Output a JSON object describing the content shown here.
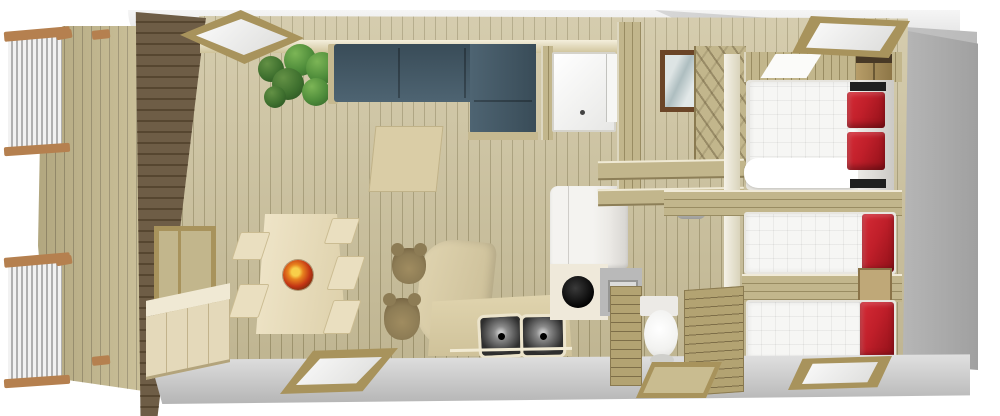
{
  "scene": {
    "kind": "3d-floorplan-render",
    "description": "Bird's-eye cutaway 3D rendering of a mobile-home / chalet floor plan with terrace",
    "background": "#ffffff",
    "width": 1000,
    "height": 416
  },
  "palette": {
    "floor_wood": "#cbc09a",
    "floor_line": "#a59a72",
    "deck_wood": "#c6ba8e",
    "deck_line": "#9e9370",
    "dark_wall": "#6e5d46",
    "dark_wall_line": "#564630",
    "wall_wood": "#c2b68c",
    "wall_wood_line": "#998c62",
    "roof_light": "#f5f5f5",
    "roof_mid": "#d7d7d7",
    "roof_dark": "#b5b5b5",
    "end_wall": "#a0a0a0",
    "sofa_blue": "#4e6472",
    "sofa_blue_dark": "#394c58",
    "bed_white": "#f6f6f4",
    "pillow_red": "#c01f2a",
    "pillow_red_dark": "#8f1018",
    "cream_furniture": "#e6dbbc",
    "frame_wood": "#a8935c",
    "glass_white": "#fbfbfb",
    "plant_green": "#4e8c3a",
    "plant_green_light": "#7cb556",
    "plant_green_dark": "#35682a",
    "bowl_orange": "#e8821e",
    "bowl_red": "#c23414",
    "bowl_yellow": "#f8cf4a",
    "bowl_brown": "#6a2d0c",
    "steel_dark": "#2e2e2e",
    "steel_mid": "#8a8a8a",
    "appliance_white": "#f4f3f0",
    "appliance_gray": "#b9b9b9",
    "stool_brown": "#8d7c55",
    "stool_brown_dark": "#6e5c3c",
    "rail_wood": "#b5804f",
    "rail_metal": "#f2f2f2",
    "rail_metal_dark": "#b0b0b0",
    "window_brown": "#6b4527",
    "toilet_white": "#f2f2f0"
  },
  "rooms": [
    {
      "name": "terrace",
      "features": [
        "wood deck",
        "two railing sections with metal balusters and wood rails"
      ]
    },
    {
      "name": "living-dining-room",
      "features": [
        "L-shaped corner sofa in slate blue",
        "dining table",
        "five chairs",
        "decorative orange bowl",
        "square rug",
        "green house plant",
        "sideboard with doors",
        "window in side wall"
      ]
    },
    {
      "name": "kitchen",
      "features": [
        "curved worktop island",
        "two bar stools",
        "double stainless sink",
        "white fridge",
        "round black basin",
        "gray appliance",
        "front counter panel"
      ]
    },
    {
      "name": "shower-room",
      "features": [
        "white shower tray with drain",
        "glass door"
      ]
    },
    {
      "name": "hallway",
      "features": [
        "brown framed window",
        "diagonal plank wall",
        "shelf tops",
        "gray cylinder appliance"
      ]
    },
    {
      "name": "wc",
      "features": [
        "white toilet",
        "slatted wood partitions",
        "wood framed floor hatch"
      ]
    },
    {
      "name": "master-bedroom",
      "features": [
        "double bed with white duvet",
        "two red pillows",
        "dark bedside ledges",
        "wardrobe",
        "white wall shelf"
      ]
    },
    {
      "name": "single-bedroom-1",
      "features": [
        "single bed with white duvet",
        "red pillow"
      ]
    },
    {
      "name": "single-bedroom-2",
      "features": [
        "single bed with white duvet",
        "red pillow",
        "bedside cube"
      ]
    }
  ],
  "counts": {
    "bedrooms": 3,
    "beds": 3,
    "red_pillows": 4,
    "roof_skylights": 5,
    "sink_basins": 2,
    "dining_chairs": 5,
    "bar_stools": 2,
    "railing_sections": 2
  }
}
